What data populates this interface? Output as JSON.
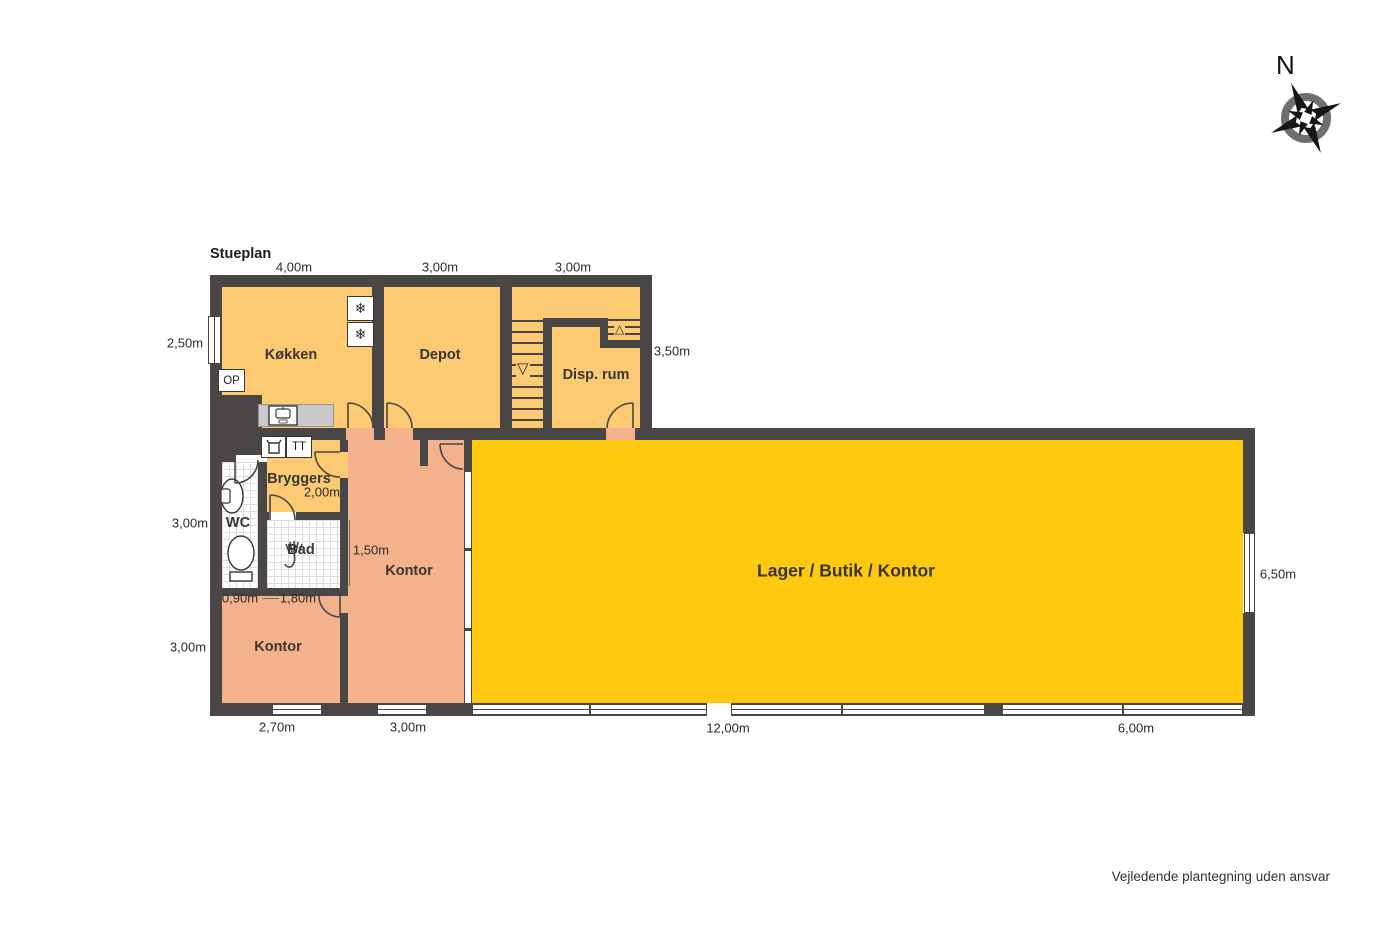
{
  "title": "Stueplan",
  "compass": {
    "label": "N"
  },
  "disclaimer": "Vejledende plantegning uden ansvar",
  "rooms": {
    "kokken": {
      "label": "Køkken"
    },
    "depot": {
      "label": "Depot"
    },
    "disp_rum": {
      "label": "Disp. rum"
    },
    "bryggers": {
      "label": "Bryggers"
    },
    "wc": {
      "label": "WC"
    },
    "bad": {
      "label": "Bad"
    },
    "kontor_mid": {
      "label": "Kontor"
    },
    "kontor_sw": {
      "label": "Kontor"
    },
    "lager": {
      "label": "Lager / Butik / Kontor"
    }
  },
  "annotations": {
    "op": "OP",
    "tt": "TT",
    "stairs_down_arrow": "▽",
    "stairs_up_arrow": "△",
    "freezer_glyph": "❄"
  },
  "dimensions": {
    "top": [
      "4,00m",
      "3,00m",
      "3,00m"
    ],
    "left": [
      "2,50m",
      "3,00m",
      "3,00m"
    ],
    "right": [
      "3,50m",
      "6,50m"
    ],
    "bottom": [
      "2,70m",
      "3,00m",
      "12,00m",
      "6,00m"
    ],
    "inner": [
      "2,00m",
      "1,50m",
      "0,90m",
      "1,80m"
    ]
  },
  "colors": {
    "wall": "#4a4645",
    "room_tan": "#fbca73",
    "room_salmon": "#f4b28c",
    "room_yellow": "#fec90e",
    "tile_line": "#dcdcdc",
    "counter": "#c9c9c9",
    "text": "#2c2c2c"
  }
}
